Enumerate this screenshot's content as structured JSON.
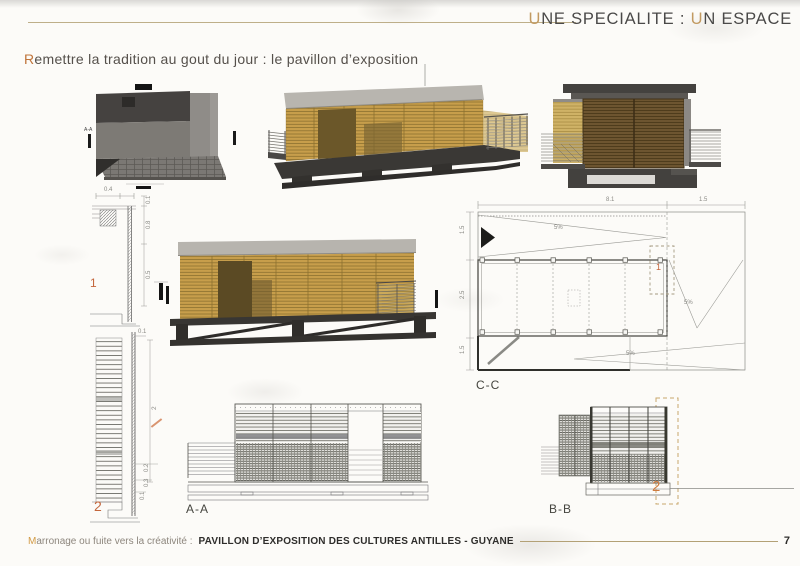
{
  "header": {
    "t1": "U",
    "t2": "NE SPECIALITE : ",
    "t3": "U",
    "t4": "N ESPACE"
  },
  "subtitle": {
    "lead": "R",
    "rest": "emettre la tradition au gout du jour : le pavillon d’exposition"
  },
  "footer": {
    "lead": "M",
    "rest": "arronage ou fuite vers la créativité :",
    "project": "PAVILLON D’EXPOSITION DES CULTURES ANTILLES - GUYANE",
    "page": "7"
  },
  "colors": {
    "accent_gold": "#c29a61",
    "accent_orange": "#c4663c",
    "wood": "#c79e4b",
    "roof_gray": "#b7b4ae",
    "base_dark": "#3a3835"
  },
  "drawings": {
    "top_view": {
      "section_mark": "A-A"
    },
    "detail_1": {
      "num": "1",
      "dim_top": "0.4",
      "dim_a": "0.1",
      "dim_b": "0.8",
      "dim_c": "0.5"
    },
    "detail_2": {
      "num": "2",
      "dim_top": "0.1",
      "dim_height": "2",
      "dim_a": "0.2",
      "dim_b": "0.3",
      "dim_c": "0.1"
    },
    "plan_cc": {
      "label": "C-C",
      "callout": "1",
      "dim_top_main": "8.1",
      "dim_top_right": "1.5",
      "dim_left_top": "1.5",
      "dim_left_mid": "2.5",
      "dim_left_bot": "1.5",
      "slope_top": "5%",
      "slope_right": "5%",
      "slope_bottom": "5%"
    },
    "elev_aa": {
      "label": "A-A"
    },
    "elev_bb": {
      "label": "B-B",
      "callout": "2"
    }
  }
}
